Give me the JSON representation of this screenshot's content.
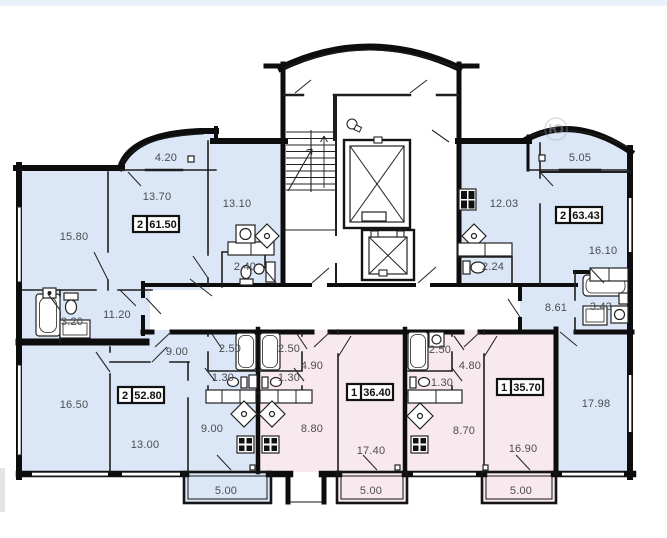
{
  "colors": {
    "wall": "#0d0d0d",
    "blue_room": "#dbe7f6",
    "pink_room": "#f8e9ee",
    "dim_text": "#4a4c50",
    "box_text": "#111111",
    "top_strip": "#e9f1fa"
  },
  "watermark": {
    "char": "Ю"
  },
  "apartments": {
    "top_left": {
      "type": "2",
      "total_area": "61.50",
      "rooms": {
        "living": "15.80",
        "bedroom": "13.70",
        "kitchen": "13.10",
        "balcony": "4.20",
        "wc": "2.40",
        "bathroom": "3.20",
        "hallway": "11.20"
      }
    },
    "top_right": {
      "type": "2",
      "total_area": "63.43",
      "rooms": {
        "kitchen": "12.03",
        "bedroom": "16.10",
        "living": "17.98",
        "balcony": "5.05",
        "wc": "2.24",
        "bathroom": "3.43",
        "hallway": "8.61"
      }
    },
    "bottom_left": {
      "type": "2",
      "total_area": "52.80",
      "rooms": {
        "living": "16.50",
        "bedroom": "13.00",
        "kitchen": "9.00",
        "hallway": "9.00",
        "bathroom": "2.50",
        "wc": "1.30",
        "balcony": "5.00"
      }
    },
    "bottom_middle": {
      "type": "1",
      "total_area": "36.40",
      "rooms": {
        "living": "17.40",
        "kitchen": "8.80",
        "hallway": "4.90",
        "bathroom": "2.50",
        "wc": "1.30",
        "balcony": "5.00"
      }
    },
    "bottom_right": {
      "type": "1",
      "total_area": "35.70",
      "rooms": {
        "living": "16.90",
        "kitchen": "8.70",
        "hallway": "4.80",
        "bathroom": "2.50",
        "wc": "1.30",
        "balcony": "5.00"
      }
    }
  }
}
